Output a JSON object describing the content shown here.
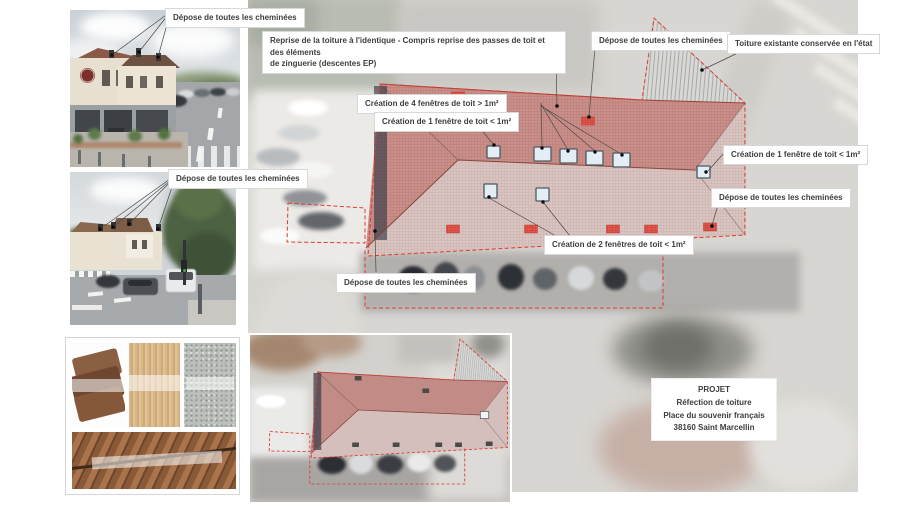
{
  "callouts": {
    "depose": "Dépose de toutes les cheminées",
    "reprise_line1": "Reprise de la toiture à l'identique - Compris reprise des passes de toit et des éléments",
    "reprise_line2": "de zinguerie (descentes EP)",
    "toiture_existante": "Toiture existante conservée en l'état",
    "creation_4": "Création de 4 fenêtres de toit > 1m²",
    "creation_1": "Création de 1 fenêtre de toit < 1m²",
    "creation_2": "Création de 2 fenêtres de toit < 1m²"
  },
  "project_box": {
    "title": "PROJET",
    "line2": "Réfection de toiture",
    "line3": "Place du souvenir français",
    "line4": "38160 Saint Marcellin"
  },
  "legend_semantics": {
    "red_hatch_rect": "cheminée à déposer",
    "blue_square": "fenêtre de toit créée",
    "pink_crosshatch": "toiture refaite à l'identique",
    "gray_hatch": "toiture existante conservée"
  },
  "colors": {
    "annotation_red": "#e03a2e",
    "roof_upper": "#c98f88",
    "roof_lower": "#d9c4c1",
    "roof_existing_gray": "#d8d8d6",
    "chimney_mark": "#e2574b",
    "leader_line": "#4a4a4a",
    "label_text": "#3d3d3d"
  }
}
